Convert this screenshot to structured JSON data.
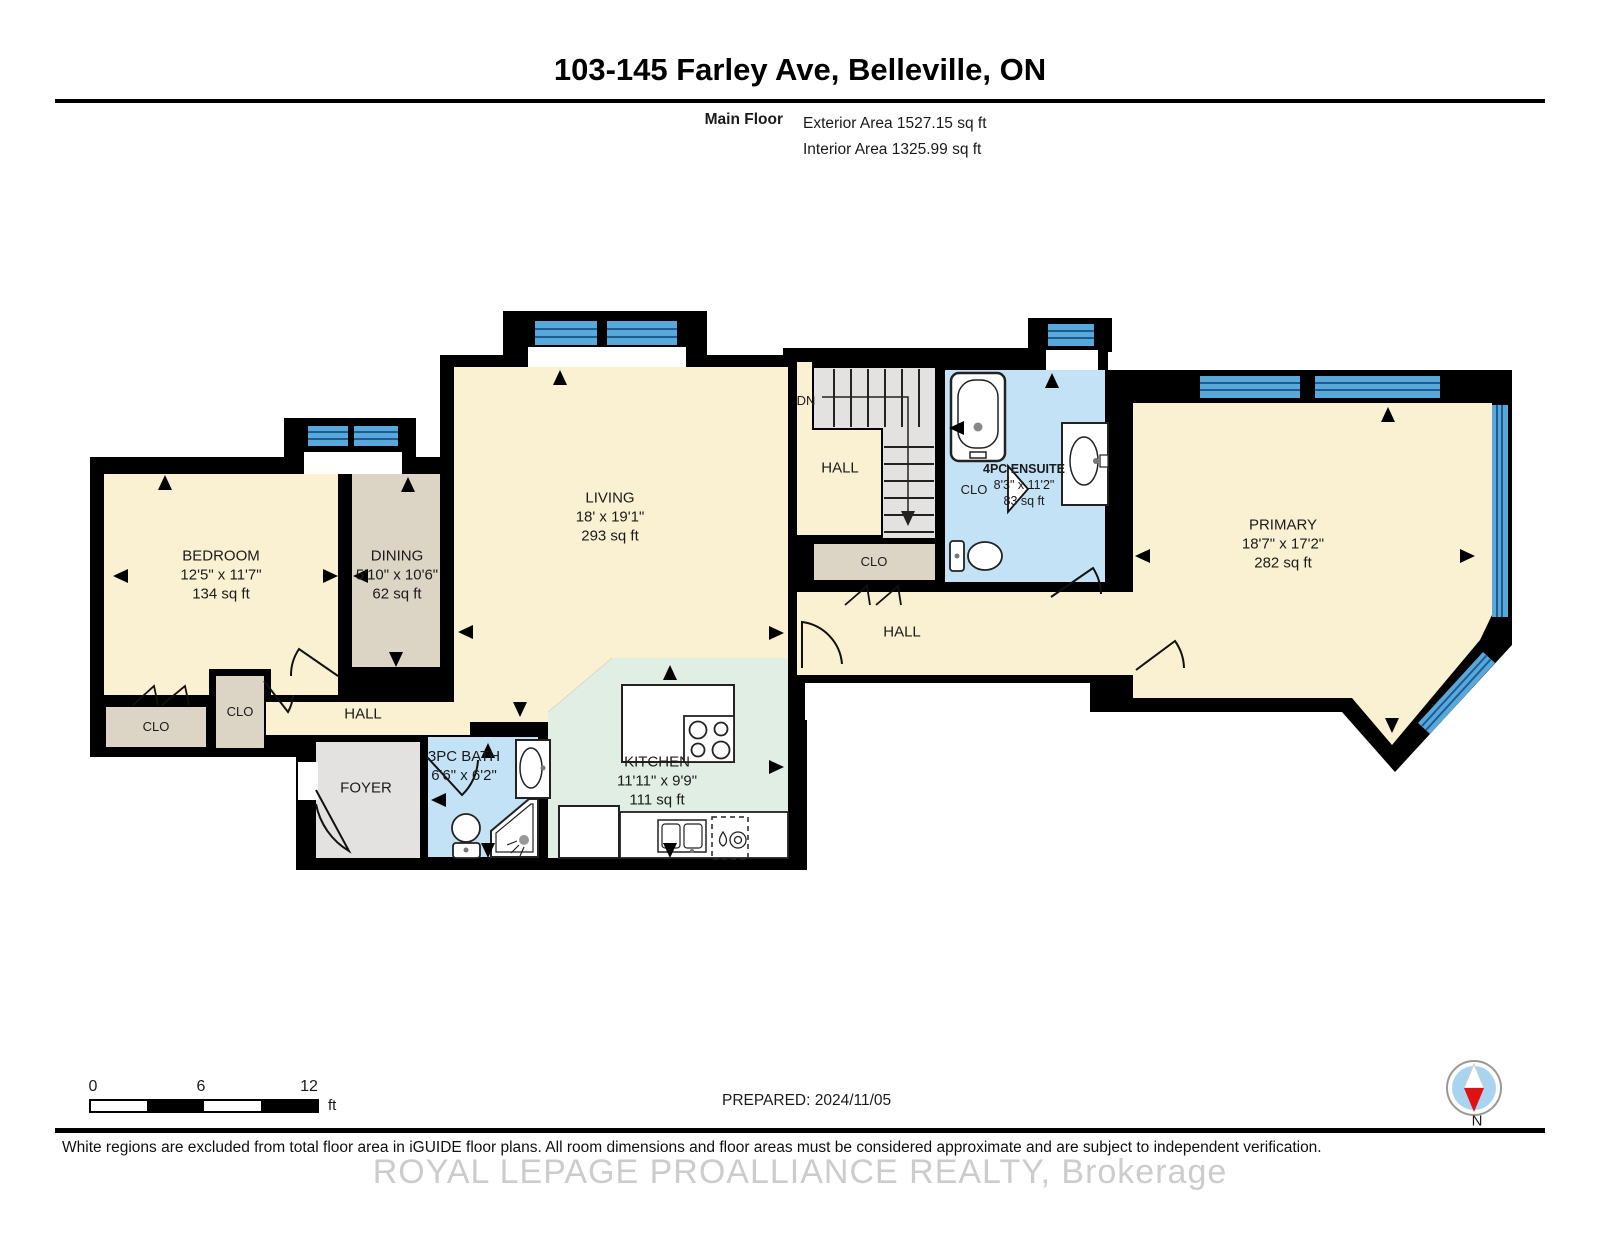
{
  "header": {
    "title": "103-145 Farley Ave, Belleville, ON",
    "floor_label": "Main Floor",
    "exterior_area": "Exterior Area 1527.15 sq ft",
    "interior_area": "Interior Area 1325.99 sq ft"
  },
  "plan": {
    "rooms": {
      "bedroom": {
        "name": "BEDROOM",
        "dims": "12'5\" x 11'7\"",
        "area": "134 sq ft"
      },
      "dining": {
        "name": "DINING",
        "dims": "5'10\" x 10'6\"",
        "area": "62 sq ft"
      },
      "living": {
        "name": "LIVING",
        "dims": "18' x 19'1\"",
        "area": "293 sq ft"
      },
      "kitchen": {
        "name": "KITCHEN",
        "dims": "11'11\" x 9'9\"",
        "area": "111 sq ft"
      },
      "bath_3pc": {
        "name": "3PC BATH",
        "dims": "6'6\" x 6'2\""
      },
      "ensuite_4pc": {
        "name": "4PC ENSUITE",
        "dims": "8'3\" x 11'2\"",
        "area": "83 sq ft"
      },
      "primary": {
        "name": "PRIMARY",
        "dims": "18'7\" x 17'2\"",
        "area": "282 sq ft"
      },
      "foyer": {
        "name": "FOYER"
      },
      "hall_left": {
        "name": "HALL"
      },
      "hall_upper": {
        "name": "HALL"
      },
      "hall_right": {
        "name": "HALL"
      },
      "closet_bedroom_left": {
        "name": "CLO"
      },
      "closet_bedroom_right": {
        "name": "CLO"
      },
      "closet_hall": {
        "name": "CLO"
      },
      "closet_ensuite": {
        "name": "CLO"
      },
      "stairs": {
        "label": "DN"
      }
    }
  },
  "scale_bar": {
    "tick_0": "0",
    "tick_6": "6",
    "tick_12": "12",
    "unit": "ft"
  },
  "footer": {
    "prepared": "PREPARED: 2024/11/05",
    "compass_label": "N",
    "disclaimer": "White regions are excluded from total floor area in iGUIDE floor plans. All room dimensions and floor areas must be considered approximate and are subject to independent verification.",
    "watermark": "ROYAL LEPAGE PROALLIANCE REALTY, Brokerage"
  },
  "colors": {
    "wall": "#000000",
    "room_cream": "#FAF0D2",
    "room_tan": "#DCD4C5",
    "room_gray": "#E3E2E0",
    "room_blue": "#C4E2F5",
    "room_green": "#E0EEE4",
    "window_blue": "#58A8DB",
    "window_stripe": "#1D5C8F",
    "compass_red": "#E01111",
    "compass_blue": "#A9D4F0"
  }
}
